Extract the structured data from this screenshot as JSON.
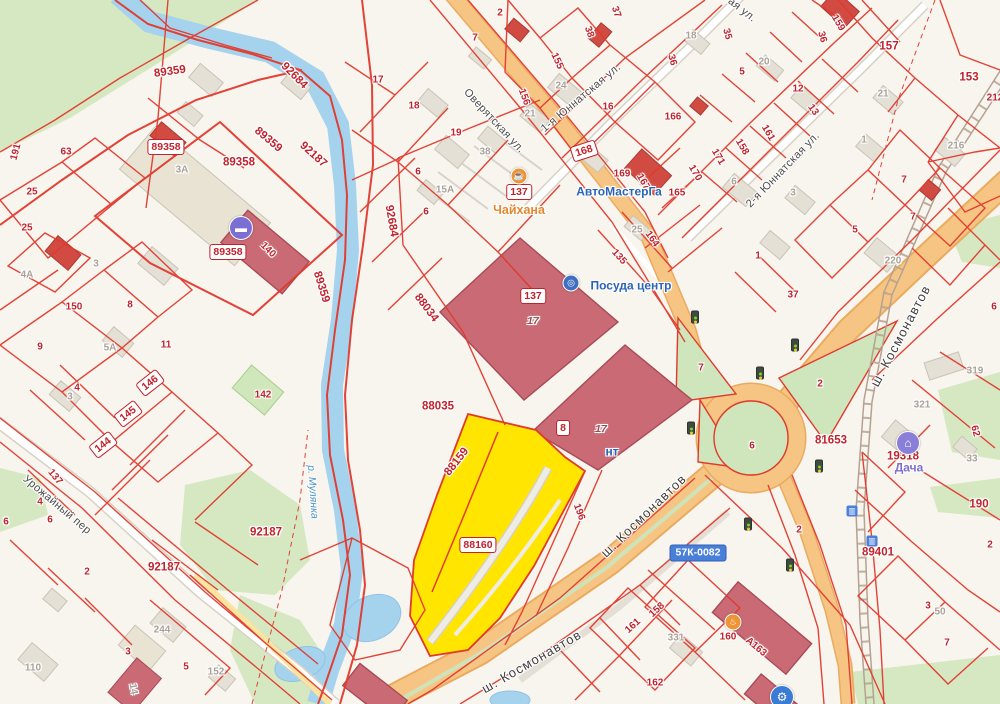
{
  "map": {
    "highlighted_parcels": [
      "88159",
      "88160"
    ],
    "colors": {
      "parcel_line": "#e13a2d",
      "parcel_label": "#c0232c",
      "selected_fill": "#ffe500",
      "road_orange": "#f7c583",
      "river": "#a5d3ee",
      "green": "#d5e8c2",
      "building_rose": "#c96a74",
      "building_red": "#d14b42",
      "route_badge_blue": "#4a7fd9"
    },
    "labels": [
      {
        "t": "89359",
        "x": 170,
        "y": 72,
        "r": -8,
        "c": "p halo",
        "n": "parcel-label"
      },
      {
        "t": "89359",
        "x": 268,
        "y": 140,
        "r": 40,
        "c": "p halo",
        "n": "parcel-label"
      },
      {
        "t": "92187",
        "x": 313,
        "y": 155,
        "r": 42,
        "c": "p halo",
        "n": "parcel-label"
      },
      {
        "t": "92684",
        "x": 294,
        "y": 76,
        "r": 45,
        "c": "p halo",
        "n": "parcel-label"
      },
      {
        "t": "92684",
        "x": 391,
        "y": 221,
        "r": 80,
        "c": "p halo",
        "n": "parcel-label"
      },
      {
        "t": "89358",
        "x": 239,
        "y": 163,
        "c": "p halo",
        "n": "parcel-label"
      },
      {
        "t": "89359",
        "x": 321,
        "y": 287,
        "r": 73,
        "c": "p halo",
        "n": "parcel-label"
      },
      {
        "t": "88034",
        "x": 426,
        "y": 308,
        "r": 53,
        "c": "p halo",
        "n": "parcel-label"
      },
      {
        "t": "88035",
        "x": 438,
        "y": 407,
        "c": "p halo",
        "n": "parcel-label"
      },
      {
        "t": "88159",
        "x": 457,
        "y": 462,
        "r": -52,
        "c": "p halo",
        "n": "parcel-label-selected"
      },
      {
        "t": "92187",
        "x": 266,
        "y": 533,
        "c": "p halo",
        "n": "parcel-label"
      },
      {
        "t": "92187",
        "x": 164,
        "y": 568,
        "c": "p halo",
        "n": "parcel-label"
      },
      {
        "t": "81653",
        "x": 831,
        "y": 441,
        "c": "p halo",
        "n": "parcel-label"
      },
      {
        "t": "19318",
        "x": 903,
        "y": 457,
        "c": "p halo",
        "n": "parcel-label"
      },
      {
        "t": "89401",
        "x": 878,
        "y": 553,
        "c": "p halo",
        "n": "parcel-label"
      },
      {
        "t": "157",
        "x": 889,
        "y": 47,
        "c": "p halo",
        "n": "parcel-label"
      },
      {
        "t": "153",
        "x": 969,
        "y": 78,
        "c": "p halo",
        "n": "parcel-label"
      },
      {
        "t": "190",
        "x": 979,
        "y": 505,
        "c": "p halo",
        "n": "parcel-label"
      },
      {
        "t": "89358",
        "x": 166,
        "y": 147,
        "c": "bd",
        "n": "parcel-badge"
      },
      {
        "t": "89358",
        "x": 228,
        "y": 252,
        "c": "bd",
        "n": "parcel-badge"
      },
      {
        "t": "137",
        "x": 519,
        "y": 192,
        "c": "bd",
        "n": "address-badge"
      },
      {
        "t": "137",
        "x": 533,
        "y": 296,
        "c": "bd",
        "n": "address-badge"
      },
      {
        "t": "8",
        "x": 563,
        "y": 428,
        "c": "bd",
        "n": "address-badge"
      },
      {
        "t": "88160",
        "x": 478,
        "y": 545,
        "c": "bd",
        "n": "selected-parcel-badge"
      },
      {
        "t": "168",
        "x": 584,
        "y": 151,
        "r": -18,
        "c": "bd",
        "n": "address-badge"
      },
      {
        "t": "146",
        "x": 150,
        "y": 383,
        "r": -38,
        "c": "bd",
        "n": "address-badge"
      },
      {
        "t": "145",
        "x": 128,
        "y": 414,
        "r": -38,
        "c": "bd",
        "n": "address-badge"
      },
      {
        "t": "144",
        "x": 103,
        "y": 445,
        "r": -38,
        "c": "bd",
        "n": "address-badge"
      },
      {
        "t": "57К-0082",
        "x": 698,
        "y": 553,
        "c": "bdb",
        "n": "route-badge"
      },
      {
        "t": "17",
        "x": 533,
        "y": 322,
        "c": "fl halo",
        "n": "floors-label"
      },
      {
        "t": "17",
        "x": 601,
        "y": 430,
        "c": "fl halo",
        "n": "floors-label"
      },
      {
        "t": "140",
        "x": 268,
        "y": 250,
        "r": 45,
        "c": "ps halo"
      },
      {
        "t": "196",
        "x": 579,
        "y": 512,
        "r": 70,
        "c": "ps halo"
      },
      {
        "t": "135",
        "x": 619,
        "y": 257,
        "r": 48,
        "c": "ps halo"
      },
      {
        "t": "17",
        "x": 378,
        "y": 80,
        "c": "ps halo"
      },
      {
        "t": "18",
        "x": 414,
        "y": 106,
        "c": "ps halo"
      },
      {
        "t": "19",
        "x": 456,
        "y": 133,
        "c": "ps halo"
      },
      {
        "t": "6",
        "x": 418,
        "y": 172,
        "c": "ps halo"
      },
      {
        "t": "6",
        "x": 426,
        "y": 212,
        "c": "ps halo"
      },
      {
        "t": "2",
        "x": 500,
        "y": 13,
        "c": "ps halo"
      },
      {
        "t": "7",
        "x": 475,
        "y": 38,
        "c": "ps halo"
      },
      {
        "t": "155",
        "x": 557,
        "y": 61,
        "r": 65,
        "c": "ps halo"
      },
      {
        "t": "156",
        "x": 524,
        "y": 97,
        "r": 70,
        "c": "ps halo"
      },
      {
        "t": "38",
        "x": 589,
        "y": 32,
        "r": 70,
        "c": "ps halo"
      },
      {
        "t": "37",
        "x": 616,
        "y": 12,
        "r": 70,
        "c": "ps halo"
      },
      {
        "t": "16",
        "x": 608,
        "y": 107,
        "c": "ps halo"
      },
      {
        "t": "169",
        "x": 622,
        "y": 174,
        "c": "ps halo"
      },
      {
        "t": "167",
        "x": 643,
        "y": 182,
        "r": 60,
        "c": "ps halo"
      },
      {
        "t": "165",
        "x": 677,
        "y": 193,
        "c": "ps halo"
      },
      {
        "t": "164",
        "x": 652,
        "y": 239,
        "r": 55,
        "c": "ps halo"
      },
      {
        "t": "166",
        "x": 673,
        "y": 117,
        "c": "ps halo"
      },
      {
        "t": "35",
        "x": 727,
        "y": 34,
        "r": 75,
        "c": "ps halo"
      },
      {
        "t": "36",
        "x": 672,
        "y": 60,
        "r": 75,
        "c": "ps halo"
      },
      {
        "t": "36",
        "x": 822,
        "y": 37,
        "r": 75,
        "c": "ps halo"
      },
      {
        "t": "159",
        "x": 838,
        "y": 23,
        "r": 60,
        "c": "ps halo"
      },
      {
        "t": "5",
        "x": 742,
        "y": 72,
        "c": "ps halo"
      },
      {
        "t": "12",
        "x": 798,
        "y": 89,
        "c": "ps halo"
      },
      {
        "t": "13",
        "x": 813,
        "y": 110,
        "r": 55,
        "c": "ps halo"
      },
      {
        "t": "161",
        "x": 768,
        "y": 133,
        "r": 60,
        "c": "ps halo"
      },
      {
        "t": "158",
        "x": 742,
        "y": 147,
        "r": 60,
        "c": "ps halo"
      },
      {
        "t": "171",
        "x": 718,
        "y": 157,
        "r": 60,
        "c": "ps halo"
      },
      {
        "t": "170",
        "x": 695,
        "y": 173,
        "r": 60,
        "c": "ps halo"
      },
      {
        "t": "212",
        "x": 995,
        "y": 98,
        "c": "ps halo"
      },
      {
        "t": "7",
        "x": 904,
        "y": 180,
        "c": "ps halo"
      },
      {
        "t": "7",
        "x": 913,
        "y": 217,
        "c": "ps halo"
      },
      {
        "t": "5",
        "x": 855,
        "y": 230,
        "c": "ps halo"
      },
      {
        "t": "1",
        "x": 758,
        "y": 256,
        "c": "ps halo"
      },
      {
        "t": "37",
        "x": 793,
        "y": 295,
        "c": "ps halo"
      },
      {
        "t": "6",
        "x": 994,
        "y": 307,
        "c": "ps halo"
      },
      {
        "t": "7",
        "x": 701,
        "y": 368,
        "c": "ps halo"
      },
      {
        "t": "2",
        "x": 820,
        "y": 384,
        "c": "ps halo"
      },
      {
        "t": "6",
        "x": 752,
        "y": 446,
        "c": "ps halo"
      },
      {
        "t": "62",
        "x": 975,
        "y": 431,
        "r": 75,
        "c": "ps halo"
      },
      {
        "t": "2",
        "x": 990,
        "y": 545,
        "c": "ps halo"
      },
      {
        "t": "2",
        "x": 799,
        "y": 530,
        "c": "ps halo"
      },
      {
        "t": "3",
        "x": 928,
        "y": 606,
        "c": "ps halo"
      },
      {
        "t": "7",
        "x": 947,
        "y": 643,
        "c": "ps halo"
      },
      {
        "t": "160",
        "x": 728,
        "y": 637,
        "c": "ps halo"
      },
      {
        "t": "А163",
        "x": 756,
        "y": 647,
        "r": 40,
        "c": "ps halo"
      },
      {
        "t": "158",
        "x": 657,
        "y": 610,
        "r": -42,
        "c": "ps halo"
      },
      {
        "t": "161",
        "x": 633,
        "y": 626,
        "r": -42,
        "c": "ps halo"
      },
      {
        "t": "162",
        "x": 655,
        "y": 683,
        "c": "ps halo"
      },
      {
        "t": "3",
        "x": 128,
        "y": 652,
        "c": "ps halo"
      },
      {
        "t": "5",
        "x": 186,
        "y": 667,
        "c": "ps halo"
      },
      {
        "t": "2",
        "x": 87,
        "y": 572,
        "c": "ps halo"
      },
      {
        "t": "4",
        "x": 40,
        "y": 502,
        "c": "ps halo"
      },
      {
        "t": "6",
        "x": 50,
        "y": 520,
        "c": "ps halo"
      },
      {
        "t": "6",
        "x": 6,
        "y": 522,
        "c": "ps halo"
      },
      {
        "t": "137",
        "x": 55,
        "y": 477,
        "r": 50,
        "c": "ps halo"
      },
      {
        "t": "25",
        "x": 32,
        "y": 192,
        "c": "ps halo"
      },
      {
        "t": "25",
        "x": 27,
        "y": 228,
        "c": "ps halo"
      },
      {
        "t": "63",
        "x": 66,
        "y": 152,
        "c": "ps halo"
      },
      {
        "t": "191",
        "x": 16,
        "y": 152,
        "r": -75,
        "c": "ps halo"
      },
      {
        "t": "150",
        "x": 74,
        "y": 307,
        "c": "ps halo"
      },
      {
        "t": "8",
        "x": 130,
        "y": 305,
        "c": "ps halo"
      },
      {
        "t": "9",
        "x": 40,
        "y": 347,
        "c": "ps halo"
      },
      {
        "t": "11",
        "x": 166,
        "y": 345,
        "c": "ps halo"
      },
      {
        "t": "4",
        "x": 77,
        "y": 388,
        "c": "ps halo"
      },
      {
        "t": "142",
        "x": 263,
        "y": 395,
        "c": "ps halo"
      },
      {
        "t": "15А",
        "x": 445,
        "y": 190,
        "c": "g halo"
      },
      {
        "t": "38",
        "x": 485,
        "y": 152,
        "c": "g halo"
      },
      {
        "t": "24",
        "x": 561,
        "y": 86,
        "c": "g halo"
      },
      {
        "t": "21",
        "x": 530,
        "y": 114,
        "c": "g halo"
      },
      {
        "t": "25",
        "x": 637,
        "y": 230,
        "c": "g halo"
      },
      {
        "t": "18",
        "x": 691,
        "y": 36,
        "c": "g halo"
      },
      {
        "t": "20",
        "x": 764,
        "y": 62,
        "c": "g halo"
      },
      {
        "t": "6",
        "x": 734,
        "y": 182,
        "c": "g halo"
      },
      {
        "t": "3",
        "x": 793,
        "y": 193,
        "c": "g halo"
      },
      {
        "t": "21",
        "x": 883,
        "y": 94,
        "c": "g halo"
      },
      {
        "t": "1",
        "x": 864,
        "y": 140,
        "c": "g halo"
      },
      {
        "t": "216",
        "x": 956,
        "y": 146,
        "c": "g halo"
      },
      {
        "t": "220",
        "x": 893,
        "y": 261,
        "c": "g halo"
      },
      {
        "t": "319",
        "x": 975,
        "y": 371,
        "c": "g halo"
      },
      {
        "t": "321",
        "x": 922,
        "y": 405,
        "c": "g halo"
      },
      {
        "t": "33",
        "x": 972,
        "y": 459,
        "c": "g halo"
      },
      {
        "t": "50",
        "x": 940,
        "y": 612,
        "c": "g halo"
      },
      {
        "t": "331",
        "x": 676,
        "y": 638,
        "c": "g halo"
      },
      {
        "t": "110",
        "x": 33,
        "y": 668,
        "c": "g halo"
      },
      {
        "t": "244",
        "x": 162,
        "y": 630,
        "c": "g halo"
      },
      {
        "t": "152",
        "x": 216,
        "y": 672,
        "c": "g halo"
      },
      {
        "t": "14",
        "x": 133,
        "y": 689,
        "r": 80,
        "c": "g halo"
      },
      {
        "t": "3",
        "x": 70,
        "y": 397,
        "c": "g halo"
      },
      {
        "t": "5А",
        "x": 110,
        "y": 348,
        "c": "g halo"
      },
      {
        "t": "3А",
        "x": 182,
        "y": 170,
        "c": "g halo"
      },
      {
        "t": "4А",
        "x": 27,
        "y": 275,
        "c": "g halo"
      },
      {
        "t": "3",
        "x": 96,
        "y": 264,
        "c": "g halo"
      },
      {
        "t": "Оверятская ул.",
        "x": 494,
        "y": 121,
        "r": 47,
        "c": "st halo",
        "n": "street-label-overyatskaya"
      },
      {
        "t": "1-я Юннатская ул.",
        "x": 581,
        "y": 98,
        "r": -40,
        "c": "st halo",
        "n": "street-label-1-yunnatskaya"
      },
      {
        "t": "2-я Юннатская ул.",
        "x": 783,
        "y": 170,
        "r": -46,
        "c": "st halo",
        "n": "street-label-2-yunnatskaya"
      },
      {
        "t": "ш. Космонавтов",
        "x": 901,
        "y": 336,
        "r": -62,
        "c": "stb halo",
        "n": "street-label-kosmonavtov"
      },
      {
        "t": "ш. Космонавтов",
        "x": 644,
        "y": 516,
        "r": -44,
        "c": "stb halo",
        "n": "street-label-kosmonavtov"
      },
      {
        "t": "ш. Космонавтов",
        "x": 532,
        "y": 662,
        "r": -30,
        "c": "stb halo",
        "n": "street-label-kosmonavtov"
      },
      {
        "t": "Урожайный пер",
        "x": 57,
        "y": 505,
        "r": 40,
        "c": "st halo",
        "n": "street-label-urozhayny"
      },
      {
        "t": "ая ул.",
        "x": 742,
        "y": 10,
        "r": 38,
        "c": "st halo",
        "n": "street-label-partial"
      },
      {
        "t": "р. Мулянка",
        "x": 312,
        "y": 492,
        "r": 86,
        "c": "riv halo",
        "n": "river-label"
      },
      {
        "t": "Чайхана",
        "x": 519,
        "y": 211,
        "c": "po halo",
        "n": "poi-label-chaikhana"
      },
      {
        "t": "АвтоМастерГа",
        "x": 619,
        "y": 192,
        "c": "pb halo",
        "n": "poi-label-avtomaster"
      },
      {
        "t": "Посуда центр",
        "x": 631,
        "y": 286,
        "c": "pb halo",
        "n": "poi-label-posuda-center"
      },
      {
        "t": "нт",
        "x": 612,
        "y": 452,
        "c": "pb halo",
        "n": "poi-label-partial"
      },
      {
        "t": "Дача",
        "x": 909,
        "y": 468,
        "c": "pp halo",
        "n": "poi-label-dacha"
      }
    ],
    "icons": [
      {
        "n": "dumbbell-icon",
        "x": 241,
        "y": 228,
        "c": "ci",
        "bg": "#7b6fd4",
        "g": "▬",
        "i": true
      },
      {
        "n": "cafe-icon",
        "x": 519,
        "y": 176,
        "c": "ci-sm",
        "bg": "#ee9435",
        "g": "☕",
        "i": true
      },
      {
        "n": "dishes-icon",
        "x": 571,
        "y": 283,
        "c": "ci-sm",
        "bg": "#3f6fc0",
        "g": "◎",
        "i": true
      },
      {
        "n": "house-icon",
        "x": 908,
        "y": 443,
        "c": "ci",
        "bg": "#8a7fd8",
        "g": "⌂",
        "i": true
      },
      {
        "n": "car-icon",
        "x": 782,
        "y": 697,
        "c": "ci",
        "bg": "#3a7bd5",
        "g": "⚙",
        "i": true
      },
      {
        "n": "food-icon",
        "x": 733,
        "y": 622,
        "c": "ci-sm",
        "bg": "#ee9435",
        "g": "♨",
        "i": true
      },
      {
        "n": "transit-icon",
        "x": 852,
        "y": 511,
        "c": "sq",
        "bg": "#4a7fd9",
        "g": "▥",
        "i": true
      },
      {
        "n": "transit-icon",
        "x": 872,
        "y": 541,
        "c": "sq",
        "bg": "#4a7fd9",
        "g": "▥",
        "i": true
      },
      {
        "n": "traffic-light-icon",
        "x": 695,
        "y": 317,
        "c": "tl",
        "i": false
      },
      {
        "n": "traffic-light-icon",
        "x": 760,
        "y": 373,
        "c": "tl",
        "i": false
      },
      {
        "n": "traffic-light-icon",
        "x": 795,
        "y": 345,
        "c": "tl",
        "i": false
      },
      {
        "n": "traffic-light-icon",
        "x": 691,
        "y": 428,
        "c": "tl",
        "i": false
      },
      {
        "n": "traffic-light-icon",
        "x": 748,
        "y": 524,
        "c": "tl",
        "i": false
      },
      {
        "n": "traffic-light-icon",
        "x": 790,
        "y": 565,
        "c": "tl",
        "i": false
      },
      {
        "n": "traffic-light-icon",
        "x": 819,
        "y": 466,
        "c": "tl",
        "i": false
      }
    ]
  }
}
